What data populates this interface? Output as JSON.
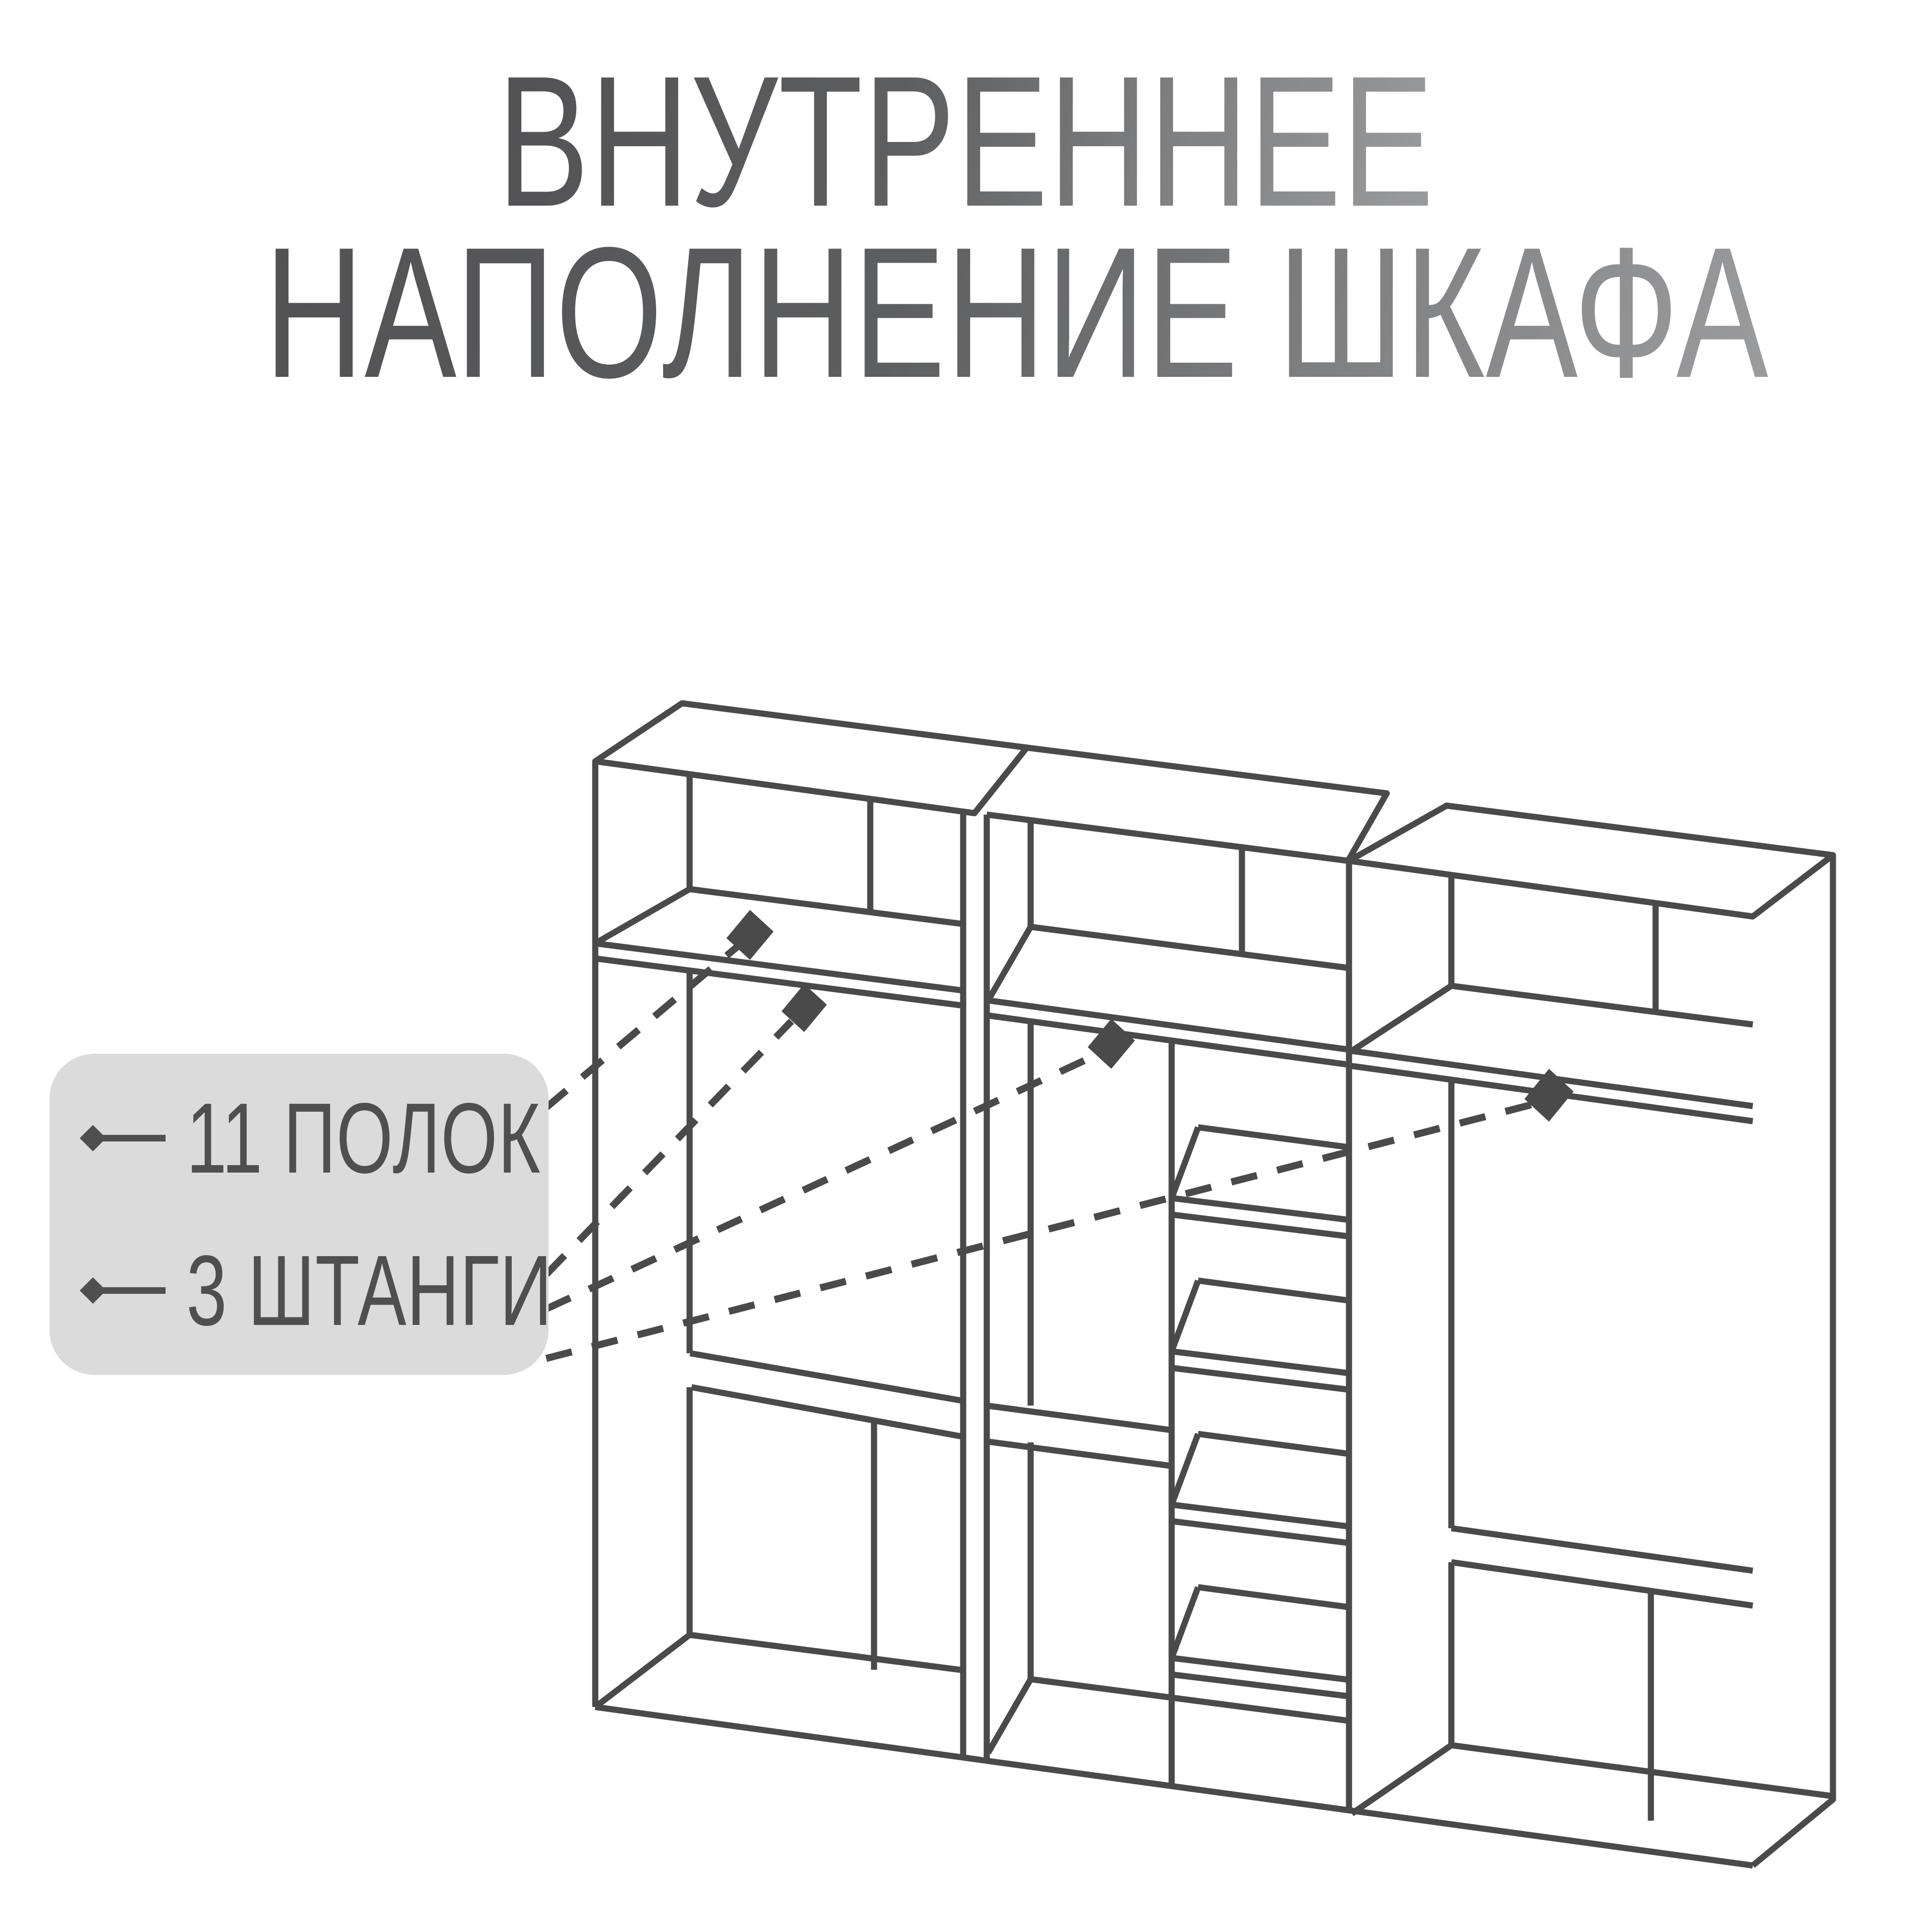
{
  "title": {
    "line1": "ВНУТРЕННЕЕ",
    "line2": "НАПОЛНЕНИЕ ШКАФА"
  },
  "legend": {
    "items": [
      {
        "label": "11 ПОЛОК"
      },
      {
        "label": "3 ШТАНГИ"
      }
    ]
  },
  "diagram": {
    "subject": "внутреннее наполнение шкафа",
    "shelves_count": 11,
    "rods_count": 3,
    "modules": 3,
    "marker_icons": [
      "diamond-marker-shelf-left",
      "diamond-marker-rod-left",
      "diamond-marker-rod-middle",
      "diamond-marker-rod-right"
    ]
  },
  "colors": {
    "background": "#ffffff",
    "line": "#4a4a4a",
    "legend_background": "#dbdbdb",
    "legend_text": "#4f4f4f",
    "title_gradient_start": "#525254",
    "title_gradient_end": "#9b9c9e"
  }
}
